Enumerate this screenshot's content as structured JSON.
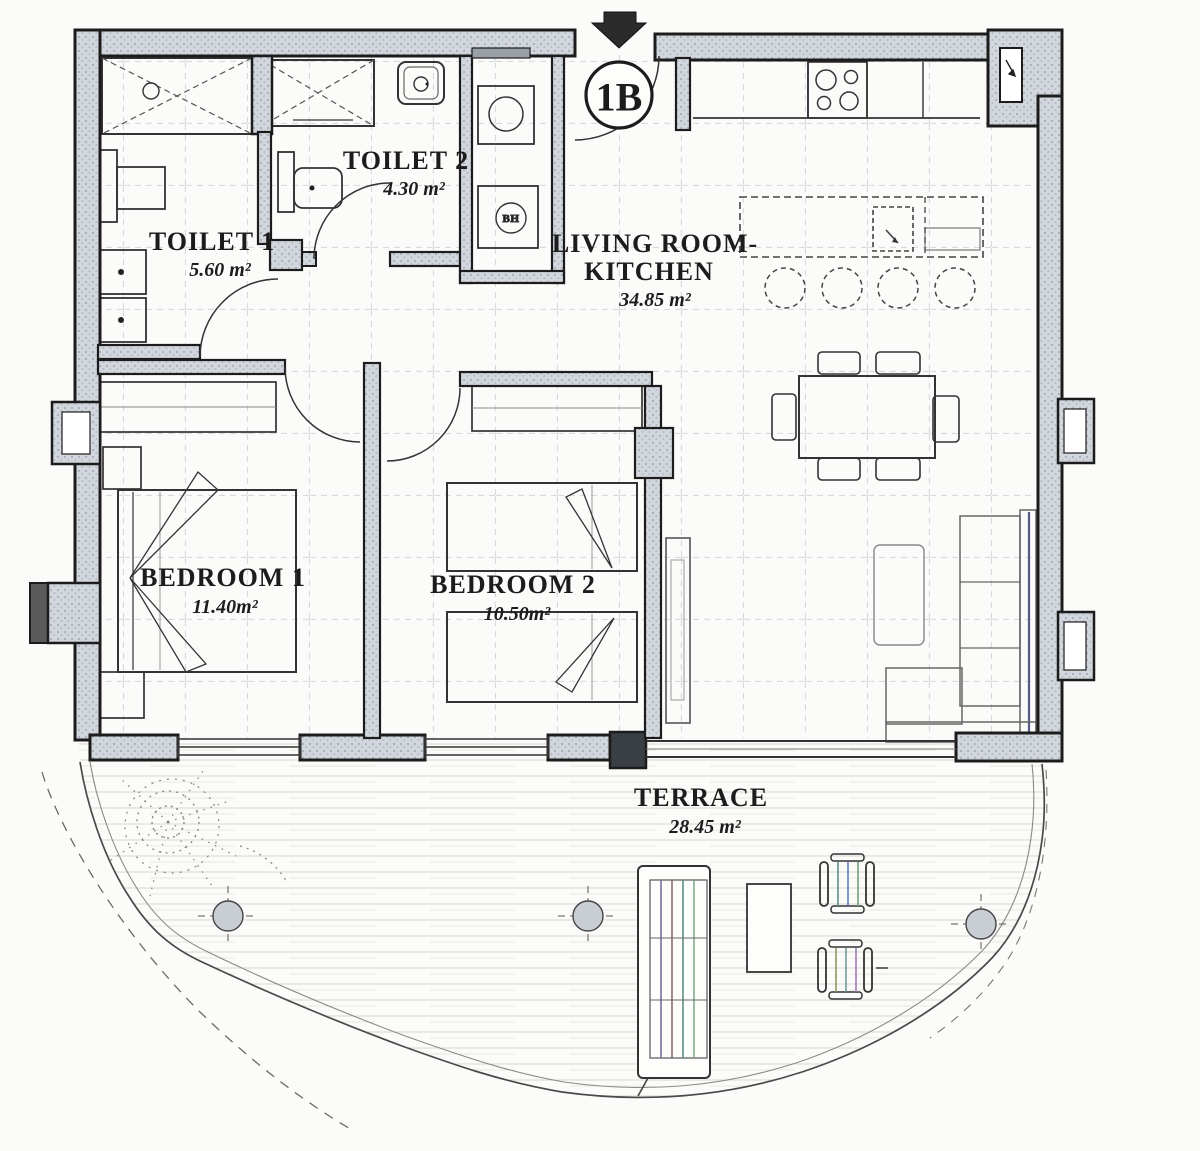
{
  "unit": {
    "label": "1B",
    "entrance_marker": "arrow-down"
  },
  "rooms": {
    "toilet1": {
      "name": "TOILET 1",
      "area": "5.60 m²"
    },
    "toilet2": {
      "name": "TOILET 2",
      "area": "4.30 m²"
    },
    "living_kitchen": {
      "name_line1": "LIVING ROOM-",
      "name_line2": "KITCHEN",
      "area": "34.85 m²"
    },
    "bedroom1": {
      "name": "BEDROOM 1",
      "area": "11.40m²"
    },
    "bedroom2": {
      "name": "BEDROOM 2",
      "area": "10.50m²"
    },
    "terrace": {
      "name": "TERRACE",
      "area": "28.45 m²"
    }
  },
  "fixtures": {
    "water_heater_label": "BH"
  },
  "colors": {
    "wall_fill": "#cfd4dc",
    "wall_line": "#1c1c1c",
    "tile_grid": "#c4cad4",
    "paper": "#fbfbf9"
  }
}
